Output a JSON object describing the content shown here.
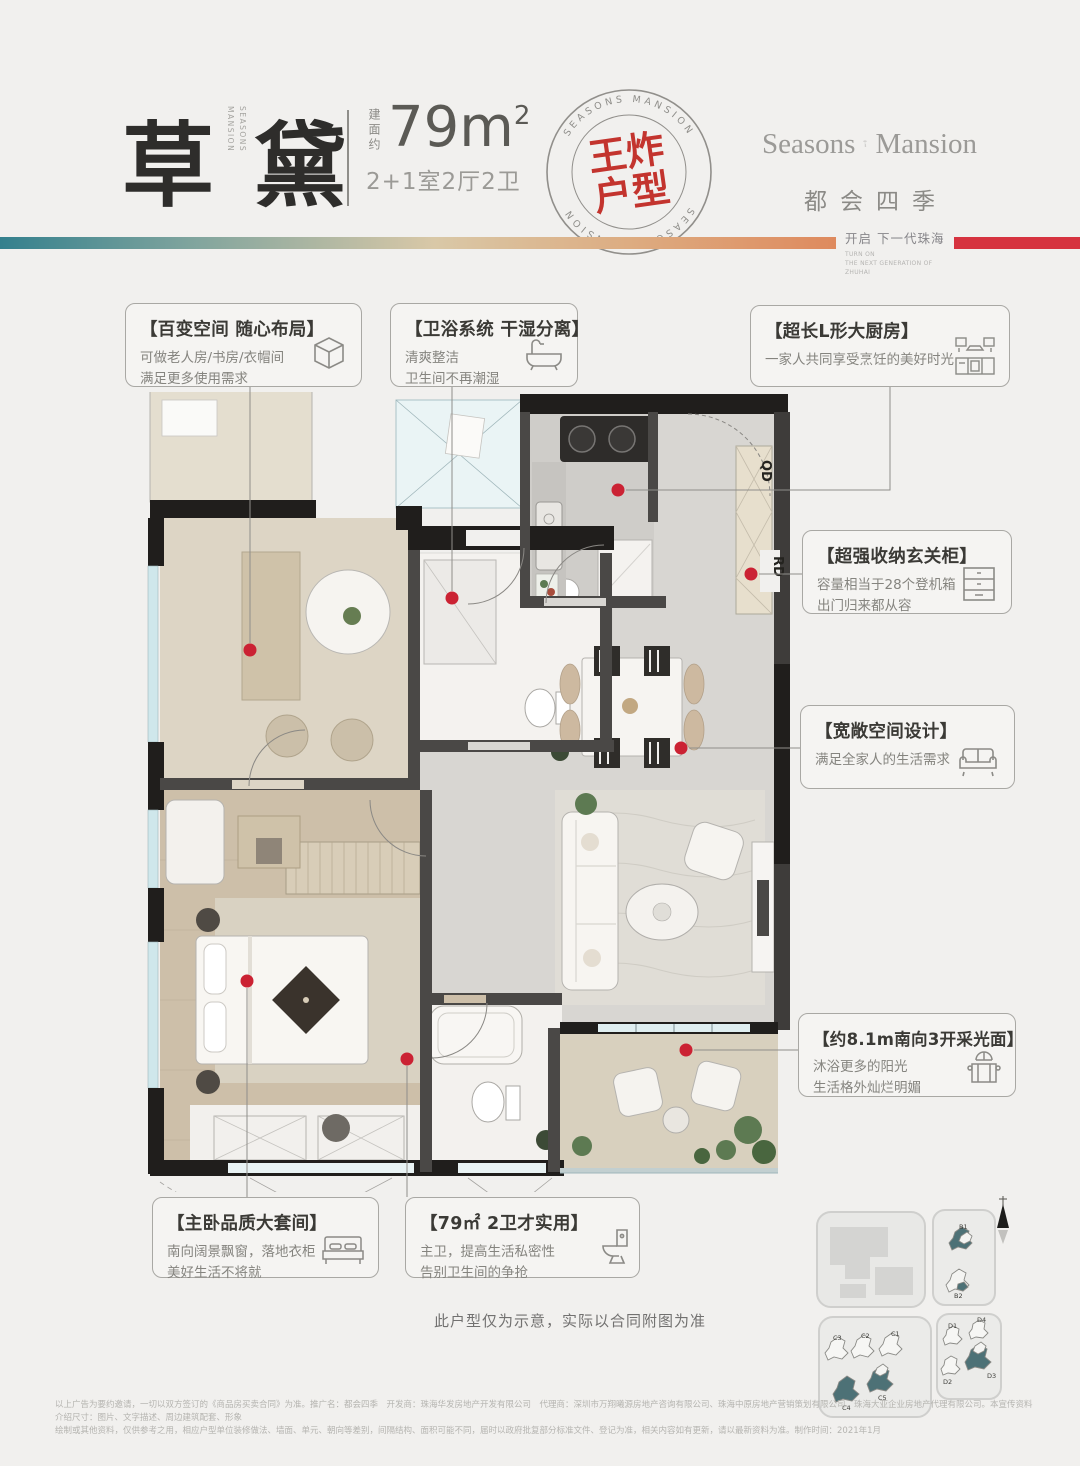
{
  "page": {
    "background": "#f1f0ee"
  },
  "header": {
    "title_char_1": "草",
    "title_char_2": "黛",
    "title_side_word_1": "SEASONS",
    "title_side_word_2": "MANSION",
    "area_label": "建面约",
    "area_value": "79m",
    "area_exponent": "2",
    "layout_spec": "2+1室2厅2卫",
    "stamp": {
      "ring_text": "SEASONS MANSION",
      "line1": "王炸",
      "line2": "户型",
      "color": "#c3342e"
    },
    "logo": {
      "en_left": "Seasons",
      "en_right": "Mansion",
      "cn": "都会四季"
    },
    "tagline_cn": "开启 下一代珠海",
    "tagline_en_1": "TURN ON",
    "tagline_en_2": "THE NEXT GENERATION OF ZHUHAI",
    "gradient_colors": {
      "left": "#34808d",
      "mid": "#d9c8a7",
      "right": "#de8a5e",
      "accent_block": "#d6333f"
    }
  },
  "callouts": [
    {
      "title": "【百变空间 随心布局】",
      "line1": "可做老人房/书房/衣帽间",
      "line2": "满足更多使用需求",
      "icon": "cube-icon"
    },
    {
      "title": "【卫浴系统 干湿分离】",
      "line1": "清爽整洁",
      "line2": "卫生间不再潮湿",
      "icon": "bathtub-icon"
    },
    {
      "title": "【超长L形大厨房】",
      "line1": "一家人共同享受烹饪的美好时光",
      "line2": "",
      "icon": "kitchen-icon"
    },
    {
      "title": "【超强收纳玄关柜】",
      "line1": "容量相当于28个登机箱",
      "line2": "出门归来都从容",
      "icon": "cabinet-icon"
    },
    {
      "title": "【宽敞空间设计】",
      "line1": "满足全家人的生活需求",
      "line2": "",
      "icon": "sofa-icon"
    },
    {
      "title": "【约8.1m南向3开采光面】",
      "line1": "沐浴更多的阳光",
      "line2": "生活格外灿烂明媚",
      "icon": "bay-window-icon"
    },
    {
      "title": "【主卧品质大套间】",
      "line1": "南向阔景飘窗，落地衣柜",
      "line2": "美好生活不将就",
      "icon": "bed-icon"
    },
    {
      "title": "【79㎡ 2卫才实用】",
      "line1": "主卫，提高生活私密性",
      "line2": "告别卫生间的争抢",
      "icon": "toilet-icon"
    }
  ],
  "floorplan": {
    "label_qd": "QD",
    "label_rd": "RD",
    "dot_color": "#cb2233",
    "note": "此户型仅为示意，实际以合同附图为准"
  },
  "siteplan": {
    "labels": [
      "B1",
      "B2",
      "C1",
      "C2",
      "C3",
      "C4",
      "C5",
      "D1",
      "D2",
      "D3",
      "D4"
    ],
    "highlight": "#4d7176"
  },
  "footer": {
    "line1": "以上广告为要约邀请，一切以双方签订的《商品房买卖合同》为准。推广名：都会四季　开发商：珠海华发房地产开发有限公司　代理商：深圳市万翔曦源房地产咨询有限公司、珠海中原房地产营销策划有限公司、珠海大亚企业房地产代理有限公司。本宣传资料介绍尺寸：图片、文字描述、周边建筑配套、形象",
    "line2": "绘制或其他资料，仅供参考之用，相应户型单位装修做法、墙面、单元、朝向等差别，间隔结构、面积可能不同，届时以政府批复部分标准文件、登记为准，相关内容如有更新，请以最新资料为准。制作时间：2021年1月"
  }
}
